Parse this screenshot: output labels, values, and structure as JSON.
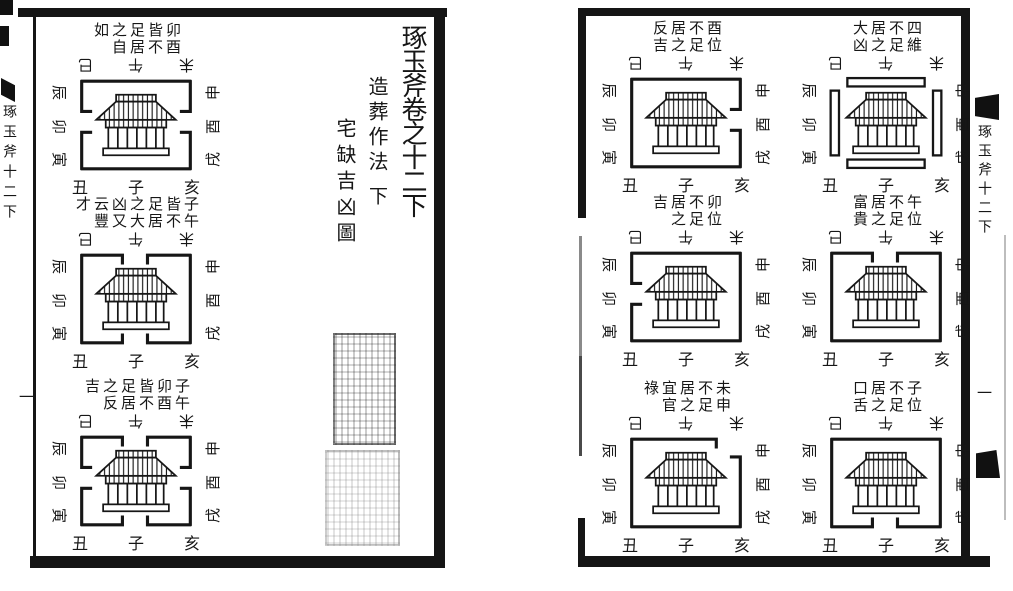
{
  "colors": {
    "ink": "#161616",
    "paper": "#ffffff"
  },
  "compass_labels": {
    "top": [
      "巳",
      "午",
      "未"
    ],
    "bottom": [
      "丑",
      "子",
      "亥"
    ],
    "left": [
      "辰",
      "卯",
      "寅"
    ],
    "right": [
      "申",
      "酉",
      "戌"
    ]
  },
  "left_page": {
    "volume_title": "琢玉斧卷之十二下",
    "subtitle": "造葬作法",
    "subtitle_suffix": "下",
    "section_title": "宅缺吉凶圖",
    "spine_label": "琢玉斧十二下",
    "folio_mark": "一",
    "diagrams": [
      {
        "caption_columns": [
          "卯酉",
          "皆不",
          "足居",
          "之自",
          "如"
        ],
        "reading": "卯酉皆不足居之自如",
        "frame": "EW"
      },
      {
        "caption_columns": [
          "子午",
          "皆不",
          "足居",
          "之大",
          "凶又",
          "云豐",
          "才"
        ],
        "reading": "子午皆不足居之大凶又云豐才",
        "frame": "NS"
      },
      {
        "caption_columns": [
          "子午",
          "卯酉",
          "皆不",
          "足居",
          "之反",
          "吉"
        ],
        "reading": "子午卯酉皆不足居之反吉",
        "frame": "NSEW"
      }
    ]
  },
  "right_page": {
    "spine_label": "琢玉斧十二下",
    "folio_mark": "一",
    "diagrams": [
      {
        "caption_columns": [
          "酉位",
          "不足",
          "居之",
          "反吉"
        ],
        "reading": "酉位不足居之反吉",
        "frame": "E"
      },
      {
        "caption_columns": [
          "四維",
          "不足",
          "居之",
          "大凶"
        ],
        "reading": "四維不足居之大凶",
        "frame": "CORNERS"
      },
      {
        "caption_columns": [
          "卯位",
          "不足",
          "居之",
          "吉"
        ],
        "reading": "卯位不足居之吉",
        "frame": "W"
      },
      {
        "caption_columns": [
          "午位",
          "不足",
          "居之",
          "富貴"
        ],
        "reading": "午位不足居之富貴",
        "frame": "N"
      },
      {
        "caption_columns": [
          "未申",
          "不足",
          "居之",
          "宜官",
          "祿"
        ],
        "reading": "未申不足居之宜官祿",
        "frame": "NE"
      },
      {
        "caption_columns": [
          "子位",
          "不足",
          "居之",
          "口舌"
        ],
        "reading": "子位不足居之口舌",
        "frame": "S"
      }
    ]
  }
}
